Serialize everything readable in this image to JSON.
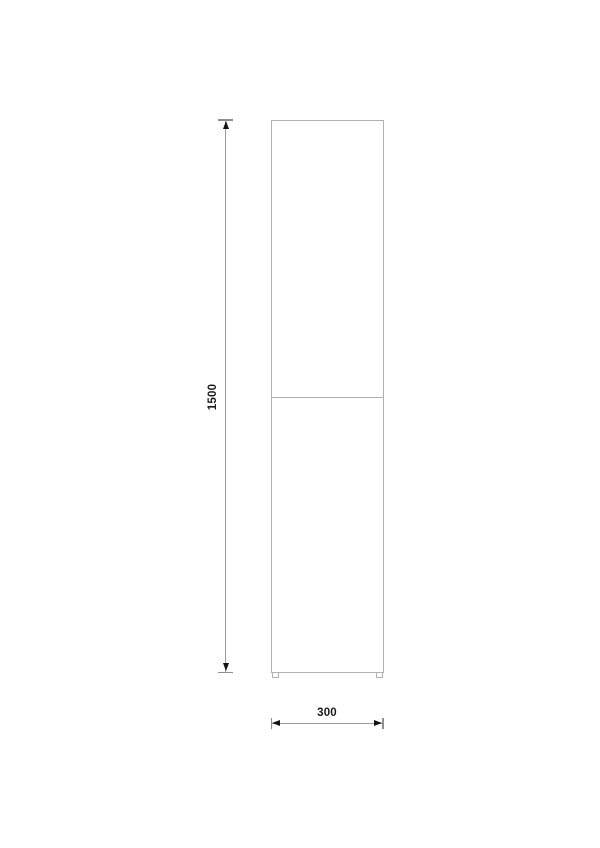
{
  "dimensions": {
    "height": "1500",
    "width": "300"
  },
  "colors": {
    "background": "#ffffff",
    "outline": "#b1b1b1",
    "dimension_line": "#9b9b9b",
    "tick": "#8f8f8f",
    "arrow": "#141414",
    "label_text": "#1a1a1a"
  }
}
